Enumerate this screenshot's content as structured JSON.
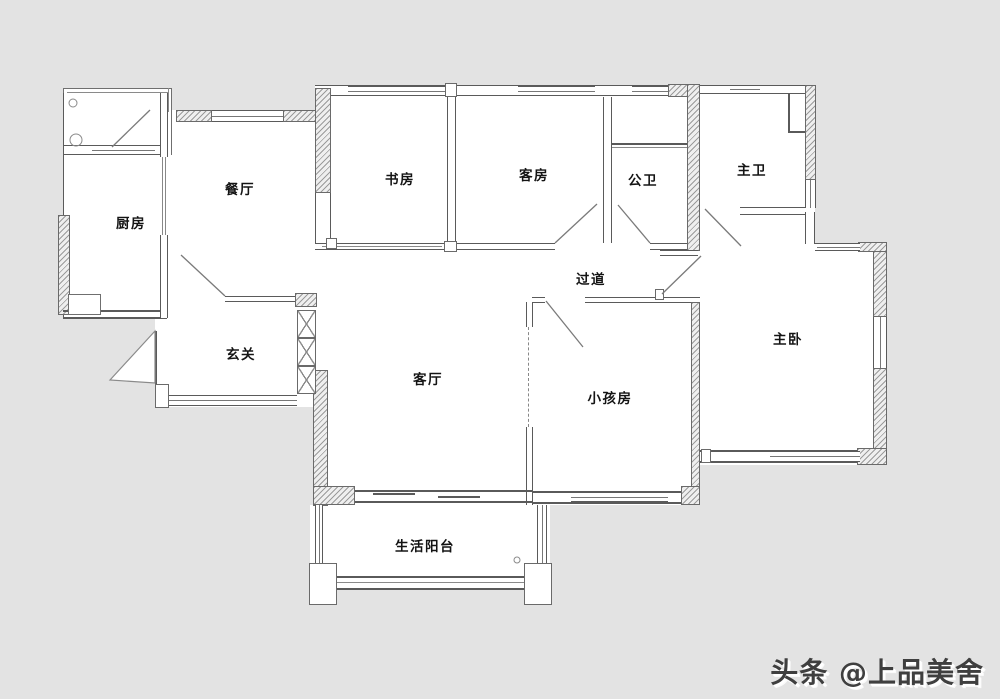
{
  "canvas": {
    "width": 1000,
    "height": 699,
    "background": "#e3e3e3",
    "wall_color": "#5a5a5a",
    "floor_color": "#ffffff"
  },
  "rooms": [
    {
      "id": "kitchen",
      "label": "厨房"
    },
    {
      "id": "dining",
      "label": "餐厅"
    },
    {
      "id": "study",
      "label": "书房"
    },
    {
      "id": "guest-room",
      "label": "客房"
    },
    {
      "id": "public-bath",
      "label": "公卫"
    },
    {
      "id": "master-bath",
      "label": "主卫"
    },
    {
      "id": "corridor",
      "label": "过道"
    },
    {
      "id": "foyer",
      "label": "玄关"
    },
    {
      "id": "living-room",
      "label": "客厅"
    },
    {
      "id": "kids-room",
      "label": "小孩房"
    },
    {
      "id": "master-bedroom",
      "label": "主卧"
    },
    {
      "id": "life-balcony",
      "label": "生活阳台"
    }
  ],
  "watermark": {
    "text": "头条 @上品美舍"
  }
}
